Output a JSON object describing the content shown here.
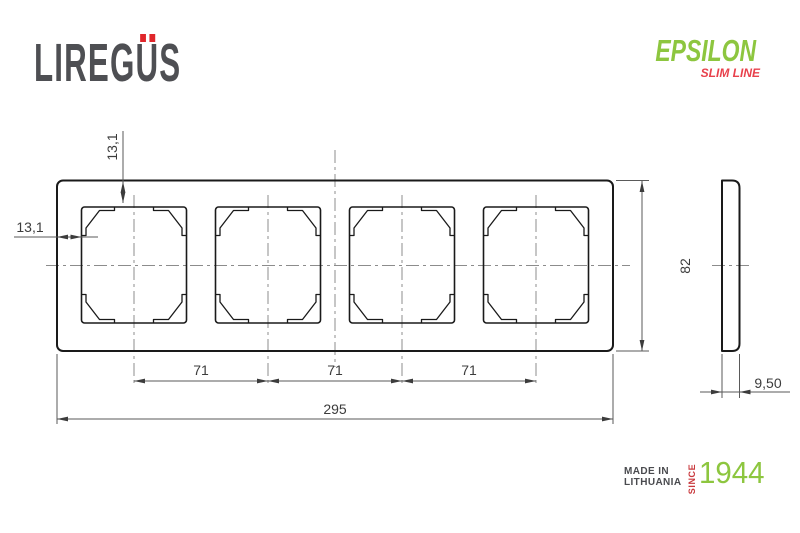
{
  "header": {
    "brand": {
      "left": "LIREG",
      "u": "U",
      "right": "S"
    },
    "product": {
      "name": "EPSILON",
      "line": "SLIM LINE"
    }
  },
  "drawing": {
    "dims": {
      "opening_offset_top": "13,1",
      "opening_offset_left": "13,1",
      "pitch1": "71",
      "pitch2": "71",
      "pitch3": "71",
      "overall_width": "295",
      "overall_height": "82",
      "depth": "9,50"
    }
  },
  "footer": {
    "made_in_line1": "MADE IN",
    "made_in_line2": "LITHUANIA",
    "since_label": "SINCE",
    "since_year": "1944"
  },
  "colors": {
    "drawing_line": "#1a1a1a",
    "dimension_line": "#5a5a5a",
    "centerline": "#8c8c8c",
    "brand_gray": "#4e4f53",
    "brand_red": "#e0262b",
    "accent_green": "#8dc63f",
    "accent_red": "#e8414c",
    "since_red": "#c9393d"
  }
}
